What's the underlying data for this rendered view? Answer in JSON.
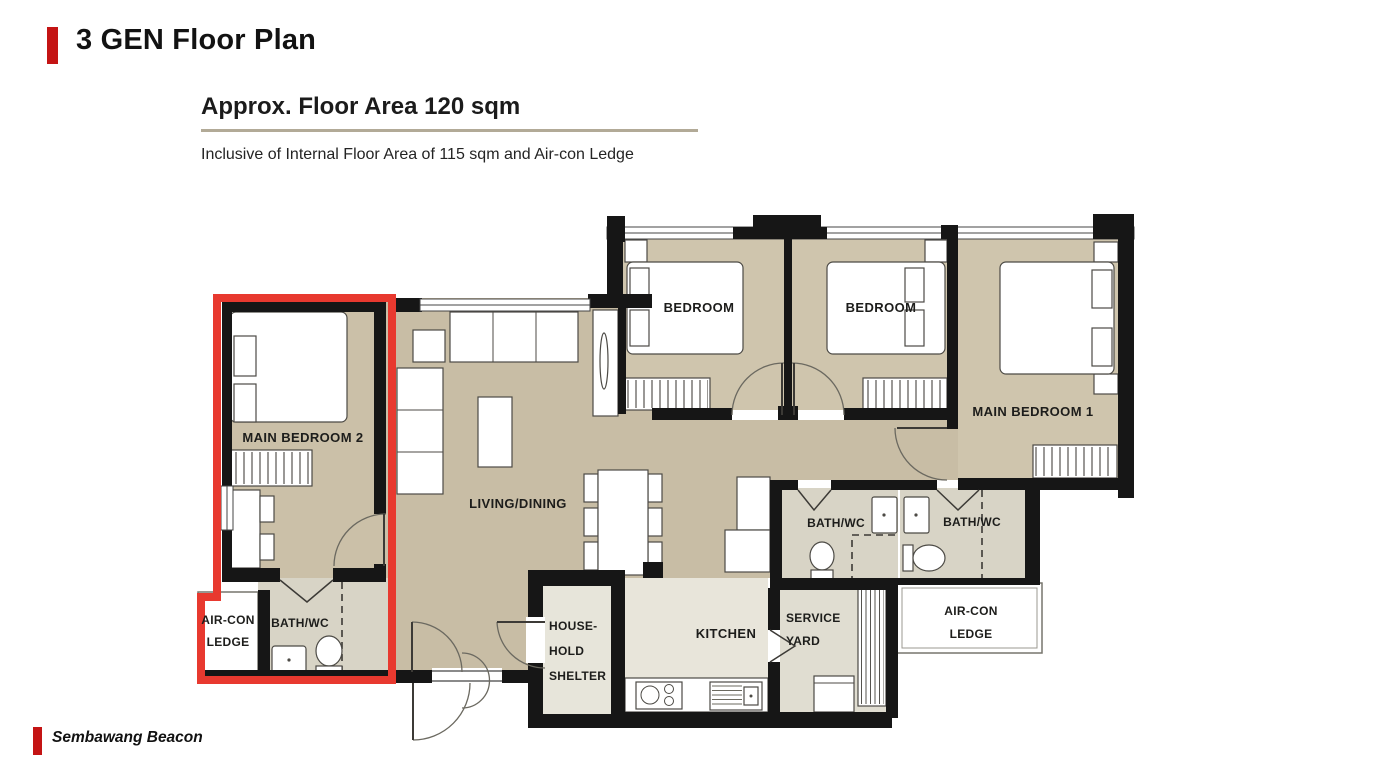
{
  "header": {
    "title": "3 GEN Floor Plan"
  },
  "floor_plan": {
    "heading": "Approx. Floor Area 120 sqm",
    "subheading": "Inclusive of Internal Floor Area of 115 sqm and Air-con Ledge",
    "highlight_color": "#e8392f",
    "rooms": {
      "main_bedroom_2": "MAIN BEDROOM 2",
      "bedroom_left": "BEDROOM",
      "bedroom_right": "BEDROOM",
      "main_bedroom_1": "MAIN BEDROOM 1",
      "living_dining": "LIVING/DINING",
      "bath_mb2": "BATH/WC",
      "bath_common": "BATH/WC",
      "bath_mb1": "BATH/WC",
      "kitchen": "KITCHEN",
      "service_yard_line1": "SERVICE",
      "service_yard_line2": "YARD",
      "household_shelter_line1": "HOUSE-",
      "household_shelter_line2": "HOLD",
      "household_shelter_line3": "SHELTER",
      "aircon_left_line1": "AIR-CON",
      "aircon_left_line2": "LEDGE",
      "aircon_right_line1": "AIR-CON",
      "aircon_right_line2": "LEDGE"
    }
  },
  "footer": {
    "project_name": "Sembawang Beacon"
  }
}
